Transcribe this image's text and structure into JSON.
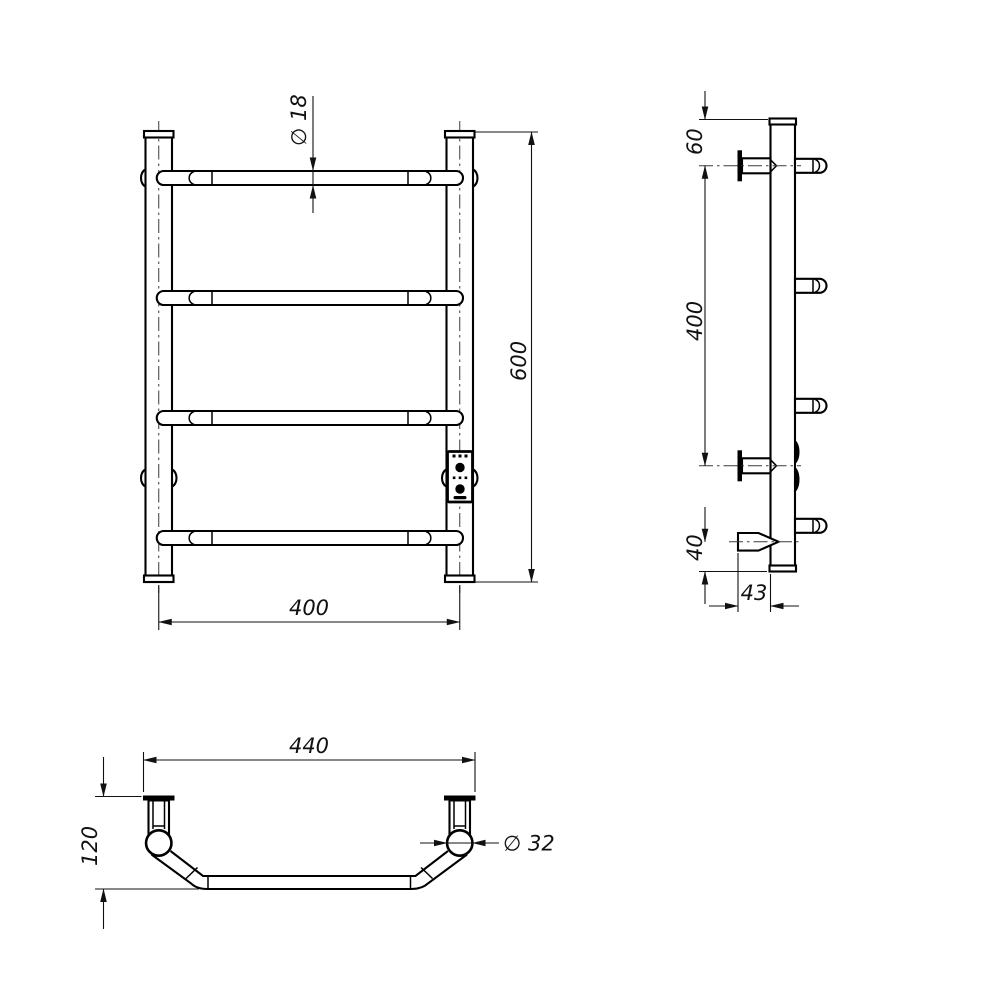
{
  "page": {
    "background": "#ffffff",
    "line_color": "#000000",
    "centerline_color": "#3c3c3c"
  },
  "views": {
    "front": {
      "dimensions": {
        "rung_diameter": "∅ 18",
        "overall_height": "600",
        "post_spacing": "400"
      }
    },
    "side": {
      "dimensions": {
        "top_to_first_rung": "60",
        "bracket_spacing": "400",
        "heater_to_bottom": "40",
        "block_depth": "43"
      }
    },
    "top": {
      "dimensions": {
        "overall_width": "440",
        "wall_to_front_depth": "120",
        "post_diameter": "∅ 32"
      }
    }
  }
}
